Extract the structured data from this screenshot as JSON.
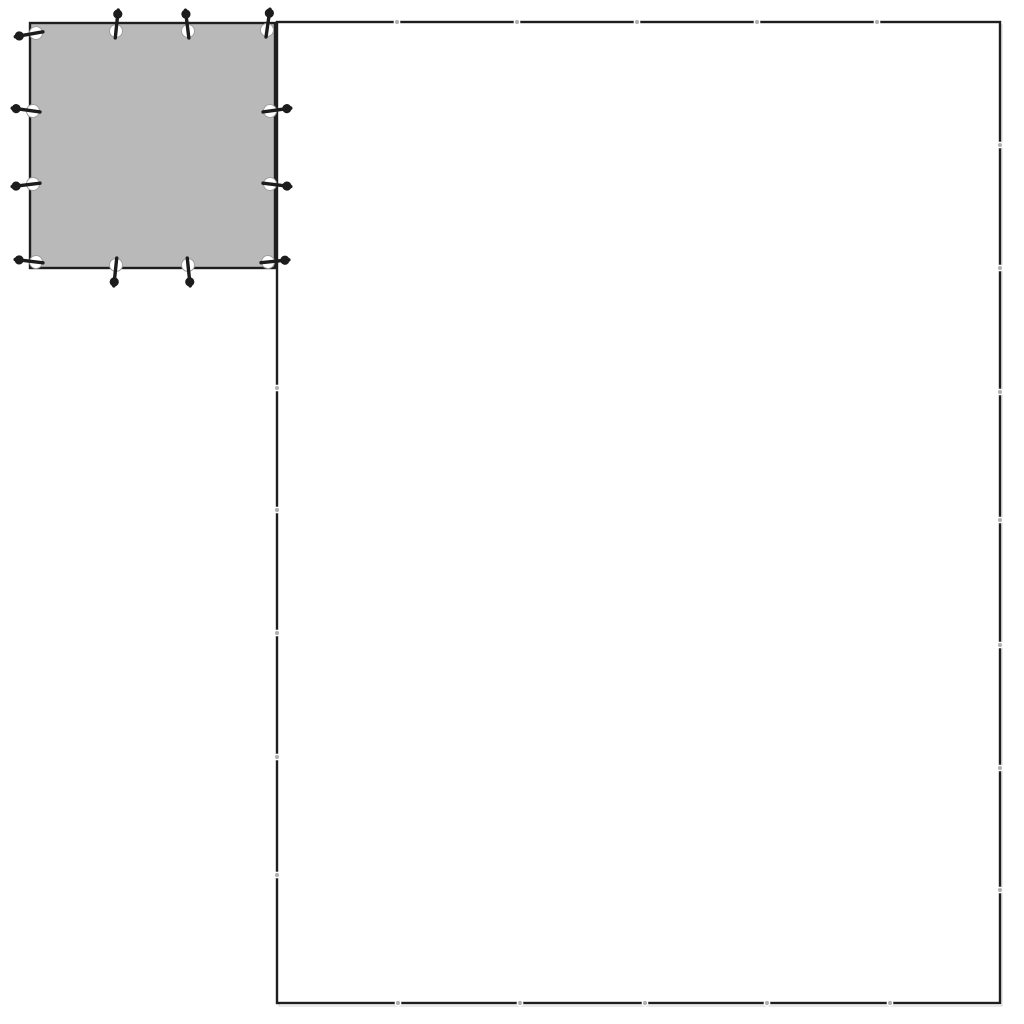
{
  "illustration": {
    "title": "tarp-size-comparison-line-art",
    "background_color": "#ffffff",
    "line_color": "#1e1e1e",
    "ghost_line_color": "#d6d6d6",
    "large_tarp": {
      "x": 277,
      "y": 22,
      "width": 723,
      "height": 981,
      "fill": "#ffffff",
      "stroke_width": 2.4,
      "grommet_mark_color": "#b0b0b0",
      "grommet_mark_gap_color": "#ffffff",
      "grommet_marks": {
        "top_x": [
          397,
          517,
          637,
          757,
          877
        ],
        "bottom_x": [
          398,
          520,
          645,
          767,
          890
        ],
        "left_y": [
          388,
          510,
          633,
          757,
          875
        ],
        "right_y": [
          145,
          268,
          392,
          520,
          645,
          768,
          890
        ]
      }
    },
    "small_tarp": {
      "x": 30,
      "y": 23,
      "width": 245,
      "height": 245,
      "fill": "#b9b9b9",
      "stroke_width": 2.4,
      "eyelet_style": {
        "radius": 6.5,
        "fill": "#ffffff",
        "ring_color": "#9e9e9e"
      },
      "peg_style": {
        "color": "#1c1c1c",
        "rod_length": 21,
        "rod_back": 7,
        "rod_width": 3.4,
        "head_radius": 4.6,
        "head_offset": 17
      },
      "eyelets": [
        {
          "x": 36,
          "y": 33,
          "peg_dir": "left",
          "tilt": -10
        },
        {
          "x": 116,
          "y": 31,
          "peg_dir": "up",
          "tilt": 6
        },
        {
          "x": 188,
          "y": 31,
          "peg_dir": "up",
          "tilt": -7
        },
        {
          "x": 267,
          "y": 30,
          "peg_dir": "up",
          "tilt": 8
        },
        {
          "x": 33,
          "y": 111,
          "peg_dir": "left",
          "tilt": 8
        },
        {
          "x": 33,
          "y": 184,
          "peg_dir": "left",
          "tilt": -7
        },
        {
          "x": 36,
          "y": 262,
          "peg_dir": "left",
          "tilt": 7
        },
        {
          "x": 270,
          "y": 111,
          "peg_dir": "right",
          "tilt": -8
        },
        {
          "x": 270,
          "y": 184,
          "peg_dir": "right",
          "tilt": 7
        },
        {
          "x": 268,
          "y": 262,
          "peg_dir": "right",
          "tilt": -6
        },
        {
          "x": 116,
          "y": 265,
          "peg_dir": "down",
          "tilt": 6
        },
        {
          "x": 188,
          "y": 265,
          "peg_dir": "down",
          "tilt": -6
        }
      ]
    }
  }
}
